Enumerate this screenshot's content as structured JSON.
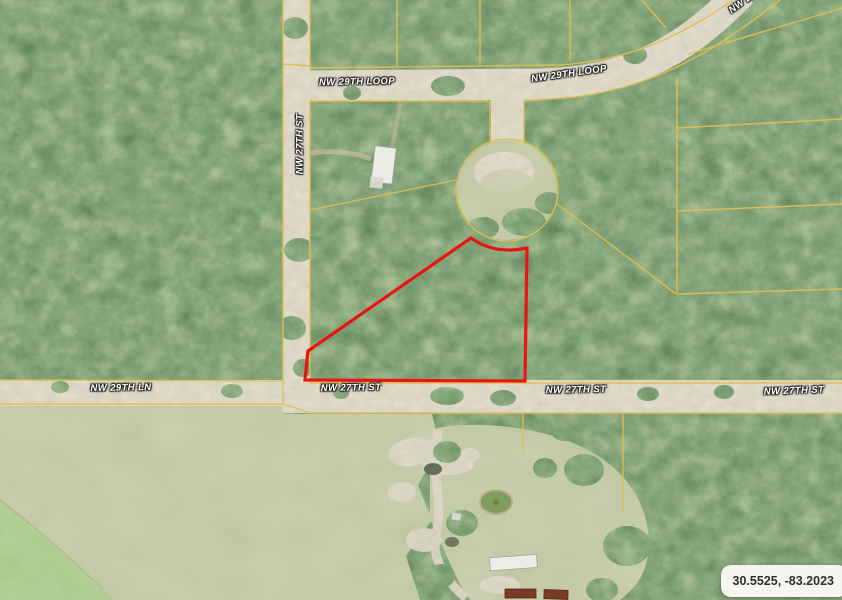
{
  "map": {
    "description": "Aerial satellite parcel map with a highlighted vacant lot outlined in red",
    "coordinates_badge": {
      "text": "30.5525, -83.2023"
    },
    "street_labels": [
      {
        "id": "loop-left",
        "text": "NW 29TH LOOP"
      },
      {
        "id": "loop-right",
        "text": "NW 29TH LOOP"
      },
      {
        "id": "loop-corner",
        "text": "NW 29TH LOOP"
      },
      {
        "id": "st-vertical",
        "text": "NW 27TH ST"
      },
      {
        "id": "ln-left",
        "text": "NW 29TH LN"
      },
      {
        "id": "st-bottom-1",
        "text": "NW 27TH ST"
      },
      {
        "id": "st-bottom-2",
        "text": "NW 27TH ST"
      },
      {
        "id": "st-bottom-3",
        "text": "NW 27TH ST"
      }
    ],
    "colors": {
      "parcel_line": "#E3BE50",
      "highlight_outline": "#EA1510",
      "forest_base": "#2F4D2B",
      "field_base": "#8F9A68",
      "road_base": "#C9BFA3",
      "label_text": "#FFFFFF",
      "coord_text": "#2E2E2E",
      "coord_bg": "#F7F5F0"
    }
  }
}
